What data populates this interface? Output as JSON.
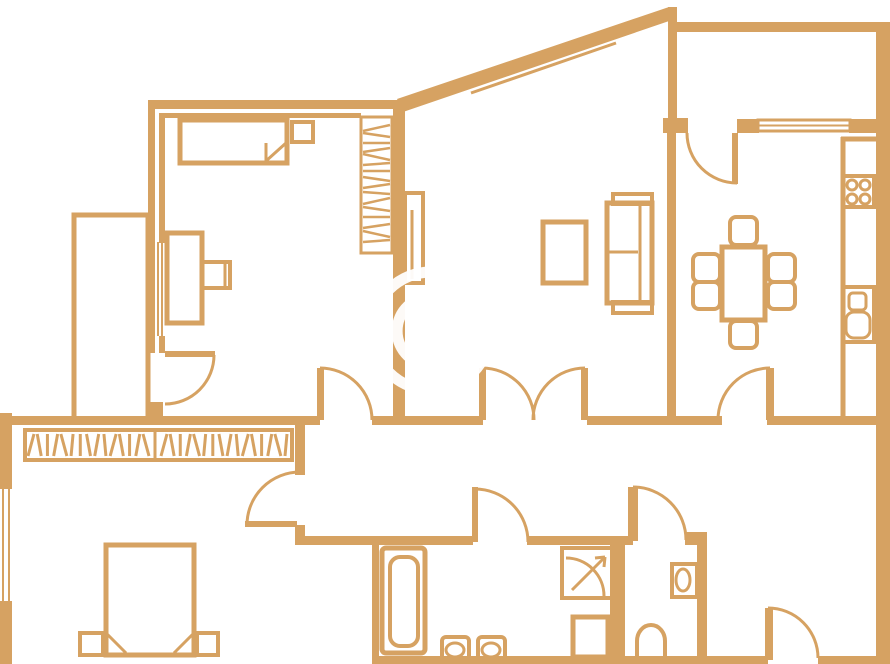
{
  "meta": {
    "description": "apartment floor plan line drawing",
    "watermark_symbol": "©"
  },
  "colors": {
    "background": "#ffffff",
    "wall": "#D6A262",
    "watermark": "#ffffff"
  },
  "canvas": {
    "width": 890,
    "height": 664
  },
  "hatch_pattern": [
    3,
    -2,
    0,
    2,
    -3,
    1,
    0,
    -2,
    2,
    -1
  ],
  "shapes": [
    {
      "name": "bedroom1-top-wall-outer",
      "type": "rect",
      "x": 148,
      "y": 100,
      "w": 258,
      "h": 9
    },
    {
      "name": "bedroom1-top-wall-inner",
      "type": "rect",
      "x": 160,
      "y": 113,
      "w": 201,
      "h": 5
    },
    {
      "name": "bedroom1-left-wall-outer",
      "type": "rect",
      "x": 148,
      "y": 100,
      "w": 7,
      "h": 253
    },
    {
      "name": "bedroom1-left-wall-inner",
      "type": "rect",
      "x": 159,
      "y": 113,
      "w": 6,
      "h": 130
    },
    {
      "name": "bedroom1-window-line-1",
      "type": "line",
      "x1": 154,
      "y1": 242,
      "x2": 154,
      "y2": 336,
      "sw": 2
    },
    {
      "name": "bedroom1-window-line-2",
      "type": "line",
      "x1": 158,
      "y1": 242,
      "x2": 158,
      "y2": 336,
      "sw": 2
    },
    {
      "name": "bedroom1-window-line-3",
      "type": "line",
      "x1": 162,
      "y1": 242,
      "x2": 162,
      "y2": 336,
      "sw": 2
    },
    {
      "name": "bedroom1-left-wall-inner-low",
      "type": "rect",
      "x": 159,
      "y": 336,
      "w": 6,
      "h": 17
    },
    {
      "name": "bedroom1-left-wall-foot",
      "type": "rect",
      "x": 148,
      "y": 402,
      "w": 15,
      "h": 23
    },
    {
      "name": "closet-room-outline",
      "type": "orect",
      "x": 74,
      "y": 215,
      "w": 74,
      "h": 207,
      "sw": 5
    },
    {
      "name": "corridor-wall-left",
      "type": "rect",
      "x": 0,
      "y": 416,
      "w": 320,
      "h": 9
    },
    {
      "name": "corridor-wall-mid",
      "type": "rect",
      "x": 372,
      "y": 416,
      "w": 111,
      "h": 9
    },
    {
      "name": "corridor-wall-right",
      "type": "rect",
      "x": 587,
      "y": 416,
      "w": 135,
      "h": 9
    },
    {
      "name": "corridor-wall-east",
      "type": "rect",
      "x": 767,
      "y": 416,
      "w": 115,
      "h": 9
    },
    {
      "name": "bedroom-living-divider-wall",
      "type": "rect",
      "x": 393,
      "y": 107,
      "w": 12,
      "h": 318
    },
    {
      "name": "diagonal-exterior-wall",
      "type": "poly",
      "points": "397,99 669,7 675,19 403,112"
    },
    {
      "name": "diagonal-window-line-1",
      "type": "line",
      "x1": 467,
      "y1": 85,
      "x2": 612,
      "y2": 35,
      "sw": 3
    },
    {
      "name": "diagonal-window-line-2",
      "type": "line",
      "x1": 471,
      "y1": 93,
      "x2": 616,
      "y2": 43,
      "sw": 3
    },
    {
      "name": "balcony-top-wall",
      "type": "rect",
      "x": 669,
      "y": 22,
      "w": 208,
      "h": 10
    },
    {
      "name": "balcony-left-wall",
      "type": "rect",
      "x": 668,
      "y": 7,
      "w": 9,
      "h": 126
    },
    {
      "name": "right-exterior-wall",
      "type": "rect",
      "x": 876,
      "y": 22,
      "w": 14,
      "h": 642
    },
    {
      "name": "kitchen-top-wall-stub",
      "type": "rect",
      "x": 663,
      "y": 118,
      "w": 25,
      "h": 15
    },
    {
      "name": "kitchen-top-wall-mid",
      "type": "rect",
      "x": 737,
      "y": 119,
      "w": 22,
      "h": 14
    },
    {
      "name": "kitchen-window-frame",
      "type": "orect",
      "x": 758,
      "y": 120,
      "w": 92,
      "h": 11,
      "sw": 3
    },
    {
      "name": "kitchen-window-midline",
      "type": "line",
      "x1": 758,
      "y1": 125.5,
      "x2": 850,
      "y2": 125.5,
      "sw": 2
    },
    {
      "name": "kitchen-top-wall-right",
      "type": "rect",
      "x": 849,
      "y": 119,
      "w": 28,
      "h": 14
    },
    {
      "name": "kitchen-living-divider-wall",
      "type": "rect",
      "x": 667,
      "y": 133,
      "w": 9,
      "h": 292
    },
    {
      "name": "bedroom2-left-exterior-wall",
      "type": "rect",
      "x": 0,
      "y": 413,
      "w": 12,
      "h": 251
    },
    {
      "name": "bedroom2-window-gap",
      "type": "rect",
      "x": 0,
      "y": 489,
      "w": 12,
      "h": 112,
      "fill": "#ffffff"
    },
    {
      "name": "bedroom2-window-line-1",
      "type": "line",
      "x1": 3,
      "y1": 489,
      "x2": 3,
      "y2": 601,
      "sw": 2
    },
    {
      "name": "bedroom2-window-line-2",
      "type": "line",
      "x1": 9,
      "y1": 489,
      "x2": 9,
      "y2": 601,
      "sw": 2
    },
    {
      "name": "bedroom2-right-wall-upper",
      "type": "rect",
      "x": 295,
      "y": 425,
      "w": 10,
      "h": 50
    },
    {
      "name": "bedroom2-right-wall-corner",
      "type": "rect",
      "x": 295,
      "y": 525,
      "w": 10,
      "h": 18
    },
    {
      "name": "hall-bottom-wall-1",
      "type": "rect",
      "x": 295,
      "y": 536,
      "w": 178,
      "h": 9
    },
    {
      "name": "hall-bottom-wall-2",
      "type": "rect",
      "x": 527,
      "y": 536,
      "w": 106,
      "h": 9
    },
    {
      "name": "hall-bottom-wall-3",
      "type": "rect",
      "x": 685,
      "y": 532,
      "w": 22,
      "h": 13
    },
    {
      "name": "bathroom-left-wall",
      "type": "rect",
      "x": 372,
      "y": 543,
      "w": 7,
      "h": 121
    },
    {
      "name": "bathroom-wc-wall",
      "type": "rect",
      "x": 610,
      "y": 543,
      "w": 15,
      "h": 121
    },
    {
      "name": "wc-right-wall",
      "type": "rect",
      "x": 697,
      "y": 543,
      "w": 10,
      "h": 121
    },
    {
      "name": "bottom-exterior-wall-1",
      "type": "rect",
      "x": 372,
      "y": 656,
      "w": 396,
      "h": 8
    },
    {
      "name": "bottom-exterior-wall-2",
      "type": "rect",
      "x": 818,
      "y": 656,
      "w": 72,
      "h": 8
    },
    {
      "name": "closet-door-leaf",
      "type": "rect",
      "x": 165,
      "y": 351,
      "w": 50,
      "h": 6
    },
    {
      "name": "closet-door-swing",
      "type": "path",
      "d": "M214,355 A49 49 0 0 1 165,404",
      "sw": 3
    },
    {
      "name": "bedroom1-door-leaf",
      "type": "rect",
      "x": 317,
      "y": 368,
      "w": 7,
      "h": 52
    },
    {
      "name": "bedroom1-door-swing",
      "type": "path",
      "d": "M320,368 A52 52 0 0 1 372,420",
      "sw": 3
    },
    {
      "name": "living-double-door-leaf-left",
      "type": "rect",
      "x": 479,
      "y": 368,
      "w": 7,
      "h": 52
    },
    {
      "name": "living-double-door-swing-left",
      "type": "path",
      "d": "M482,368 A52 52 0 0 1 534,420",
      "sw": 3
    },
    {
      "name": "living-double-door-leaf-right",
      "type": "rect",
      "x": 581,
      "y": 368,
      "w": 7,
      "h": 52
    },
    {
      "name": "living-double-door-swing-right",
      "type": "path",
      "d": "M585,368 A52 52 0 0 0 533,420",
      "sw": 3
    },
    {
      "name": "kitchen-door-leaf",
      "type": "rect",
      "x": 766,
      "y": 368,
      "w": 8,
      "h": 52
    },
    {
      "name": "kitchen-door-swing",
      "type": "path",
      "d": "M770,368 A52 52 0 0 0 718,420",
      "sw": 3
    },
    {
      "name": "balcony-door-leaf",
      "type": "rect",
      "x": 732,
      "y": 133,
      "w": 6,
      "h": 51
    },
    {
      "name": "balcony-door-swing",
      "type": "path",
      "d": "M687,133 A50 50 0 0 0 737,183",
      "sw": 3
    },
    {
      "name": "bedroom2-door-leaf",
      "type": "rect",
      "x": 245,
      "y": 521,
      "w": 52,
      "h": 6
    },
    {
      "name": "bedroom2-door-swing",
      "type": "path",
      "d": "M247,525 A53 53 0 0 1 300,472",
      "sw": 3
    },
    {
      "name": "bathroom-door-leaf",
      "type": "rect",
      "x": 472,
      "y": 487,
      "w": 6,
      "h": 55
    },
    {
      "name": "bathroom-door-swing",
      "type": "path",
      "d": "M475,489 A53 53 0 0 1 528,542",
      "sw": 3
    },
    {
      "name": "wc-door-leaf",
      "type": "rect",
      "x": 628,
      "y": 487,
      "w": 10,
      "h": 54
    },
    {
      "name": "wc-door-swing",
      "type": "path",
      "d": "M633,487 A53 53 0 0 1 686,540",
      "sw": 3
    },
    {
      "name": "entrance-door-leaf",
      "type": "rect",
      "x": 765,
      "y": 608,
      "w": 8,
      "h": 52
    },
    {
      "name": "entrance-door-swing",
      "type": "path",
      "d": "M768,608 A50 50 0 0 1 818,658",
      "sw": 3
    },
    {
      "name": "bedroom1-bed",
      "type": "orect",
      "x": 180,
      "y": 120,
      "w": 107,
      "h": 43,
      "sw": 5
    },
    {
      "name": "bedroom1-bed-fold-line",
      "type": "line",
      "x1": 266,
      "y1": 143,
      "x2": 266,
      "y2": 161,
      "sw": 3
    },
    {
      "name": "bedroom1-bed-fold-diag",
      "type": "line",
      "x1": 266,
      "y1": 161,
      "x2": 286,
      "y2": 143,
      "sw": 3
    },
    {
      "name": "bedroom1-nightstand",
      "type": "orect",
      "x": 292,
      "y": 122,
      "w": 21,
      "h": 20,
      "sw": 4
    },
    {
      "name": "bedroom1-desk",
      "type": "orect",
      "x": 167,
      "y": 233,
      "w": 35,
      "h": 90,
      "sw": 5
    },
    {
      "name": "bedroom1-chair",
      "type": "orect",
      "x": 202,
      "y": 262,
      "w": 28,
      "h": 26,
      "sw": 4
    },
    {
      "name": "bedroom1-chair-back",
      "type": "line",
      "x1": 225,
      "y1": 264,
      "x2": 225,
      "y2": 286,
      "sw": 3
    },
    {
      "name": "wardrobe-outline",
      "type": "orect",
      "x": 361,
      "y": 117,
      "w": 31,
      "h": 136,
      "sw": 3
    },
    {
      "name": "wardrobe-hangers-hatch",
      "type": "hhatch",
      "x0": 363,
      "x1": 390,
      "ys": [
        128,
        135,
        143,
        150,
        157,
        164,
        171,
        179,
        186,
        193,
        201,
        209,
        217,
        226,
        234,
        241
      ]
    },
    {
      "name": "sliding-panel",
      "type": "orect",
      "x": 405,
      "y": 193,
      "w": 18,
      "h": 90,
      "sw": 4
    },
    {
      "name": "sliding-panel-inner-line",
      "type": "line",
      "x1": 412,
      "y1": 210,
      "x2": 412,
      "y2": 279,
      "sw": 3
    },
    {
      "name": "tv-stand",
      "type": "orect",
      "x": 543,
      "y": 222,
      "w": 43,
      "h": 61,
      "sw": 5
    },
    {
      "name": "sofa-body",
      "type": "orect",
      "x": 607,
      "y": 203,
      "w": 45,
      "h": 100,
      "sw": 5
    },
    {
      "name": "sofa-back-line",
      "type": "line",
      "x1": 640,
      "y1": 205,
      "x2": 640,
      "y2": 301,
      "sw": 3
    },
    {
      "name": "sofa-seat-line",
      "type": "line",
      "x1": 609,
      "y1": 252,
      "x2": 638,
      "y2": 252,
      "sw": 3
    },
    {
      "name": "sofa-armrest-top",
      "type": "orect",
      "x": 613,
      "y": 194,
      "w": 39,
      "h": 10,
      "sw": 4
    },
    {
      "name": "sofa-armrest-bottom",
      "type": "orect",
      "x": 613,
      "y": 302,
      "w": 39,
      "h": 11,
      "sw": 4
    },
    {
      "name": "dining-table",
      "type": "orect",
      "x": 722,
      "y": 247,
      "w": 43,
      "h": 73,
      "sw": 5
    },
    {
      "name": "dining-chair-top",
      "type": "orect",
      "x": 730,
      "y": 217,
      "w": 27,
      "h": 28,
      "sw": 4,
      "rx": 6
    },
    {
      "name": "dining-chair-left-1",
      "type": "orect",
      "x": 693,
      "y": 254,
      "w": 27,
      "h": 28,
      "sw": 4,
      "rx": 6
    },
    {
      "name": "dining-chair-left-2",
      "type": "orect",
      "x": 693,
      "y": 282,
      "w": 27,
      "h": 27,
      "sw": 4,
      "rx": 6
    },
    {
      "name": "dining-chair-right-1",
      "type": "orect",
      "x": 768,
      "y": 254,
      "w": 27,
      "h": 28,
      "sw": 4,
      "rx": 6
    },
    {
      "name": "dining-chair-right-2",
      "type": "orect",
      "x": 768,
      "y": 282,
      "w": 27,
      "h": 27,
      "sw": 4,
      "rx": 6
    },
    {
      "name": "dining-chair-bottom",
      "type": "orect",
      "x": 730,
      "y": 321,
      "w": 27,
      "h": 27,
      "sw": 4,
      "rx": 6
    },
    {
      "name": "kitchen-counter-left-edge",
      "type": "line",
      "x1": 843,
      "y1": 137,
      "x2": 843,
      "y2": 416,
      "sw": 5
    },
    {
      "name": "kitchen-counter-top-edge",
      "type": "line",
      "x1": 841,
      "y1": 139,
      "x2": 876,
      "y2": 139,
      "sw": 5
    },
    {
      "name": "stove-box",
      "type": "orect",
      "x": 843,
      "y": 176,
      "w": 31,
      "h": 31,
      "sw": 4
    },
    {
      "name": "stove-burner-1",
      "type": "circle",
      "cx": 852,
      "cy": 185,
      "r": 5,
      "sw": 3
    },
    {
      "name": "stove-burner-2",
      "type": "circle",
      "cx": 865,
      "cy": 185,
      "r": 5,
      "sw": 3
    },
    {
      "name": "stove-burner-3",
      "type": "circle",
      "cx": 852,
      "cy": 199,
      "r": 5,
      "sw": 3
    },
    {
      "name": "stove-burner-4",
      "type": "circle",
      "cx": 865,
      "cy": 199,
      "r": 5,
      "sw": 3
    },
    {
      "name": "kitchen-sink-box",
      "type": "orect",
      "x": 843,
      "y": 287,
      "w": 31,
      "h": 55,
      "sw": 4
    },
    {
      "name": "kitchen-sink-basin-small",
      "type": "orect",
      "x": 849,
      "y": 293,
      "w": 17,
      "h": 17,
      "sw": 3,
      "rx": 4
    },
    {
      "name": "kitchen-sink-basin-large",
      "type": "orect",
      "x": 846,
      "y": 312,
      "w": 24,
      "h": 26,
      "sw": 3,
      "rx": 8
    },
    {
      "name": "bookshelf-outline",
      "type": "orect",
      "x": 25,
      "y": 430,
      "w": 267,
      "h": 30,
      "sw": 4
    },
    {
      "name": "bookshelf-divider",
      "type": "line",
      "x1": 155,
      "y1": 432,
      "x2": 155,
      "y2": 458,
      "sw": 3
    },
    {
      "name": "bookshelf-books-left",
      "type": "books",
      "x0": 31,
      "x1": 146,
      "n": 15,
      "y0": 434,
      "y1": 456
    },
    {
      "name": "bookshelf-books-right",
      "type": "books",
      "x0": 164,
      "x1": 286,
      "n": 16,
      "y0": 434,
      "y1": 456
    },
    {
      "name": "bedroom2-bed",
      "type": "orect",
      "x": 106,
      "y": 545,
      "w": 88,
      "h": 110,
      "sw": 5
    },
    {
      "name": "bedroom2-bed-fold-left",
      "type": "line",
      "x1": 107,
      "y1": 634,
      "x2": 126,
      "y2": 653,
      "sw": 3
    },
    {
      "name": "bedroom2-bed-fold-right",
      "type": "line",
      "x1": 193,
      "y1": 634,
      "x2": 174,
      "y2": 653,
      "sw": 3
    },
    {
      "name": "bedroom2-nightstand-left",
      "type": "orect",
      "x": 80,
      "y": 633,
      "w": 23,
      "h": 22,
      "sw": 4
    },
    {
      "name": "bedroom2-nightstand-right",
      "type": "orect",
      "x": 197,
      "y": 633,
      "w": 21,
      "h": 22,
      "sw": 4
    },
    {
      "name": "bathtub-outer",
      "type": "orect",
      "x": 382,
      "y": 548,
      "w": 43,
      "h": 105,
      "sw": 5,
      "rx": 4
    },
    {
      "name": "bathtub-inner",
      "type": "orect",
      "x": 390,
      "y": 557,
      "w": 28,
      "h": 89,
      "sw": 4,
      "rx": 10
    },
    {
      "name": "washbasin-1-box",
      "type": "orect",
      "x": 442,
      "y": 637,
      "w": 27,
      "h": 25,
      "sw": 4,
      "rx": 4
    },
    {
      "name": "washbasin-1-bowl",
      "type": "ellipse",
      "cx": 455,
      "cy": 650,
      "rx": 9,
      "ry": 7,
      "sw": 3
    },
    {
      "name": "washbasin-2-box",
      "type": "orect",
      "x": 478,
      "y": 637,
      "w": 27,
      "h": 25,
      "sw": 4,
      "rx": 4
    },
    {
      "name": "washbasin-2-bowl",
      "type": "ellipse",
      "cx": 491,
      "cy": 650,
      "rx": 9,
      "ry": 7,
      "sw": 3
    },
    {
      "name": "shower-box",
      "type": "orect",
      "x": 562,
      "y": 548,
      "w": 50,
      "h": 50,
      "sw": 4
    },
    {
      "name": "shower-arc",
      "type": "path",
      "d": "M566,558 A38 38 0 0 1 604,596",
      "sw": 3
    },
    {
      "name": "shower-arrow-diag",
      "type": "line",
      "x1": 572,
      "y1": 590,
      "x2": 605,
      "y2": 557,
      "sw": 3
    },
    {
      "name": "shower-arrow-head-1",
      "type": "line",
      "x1": 605,
      "y1": 557,
      "x2": 595,
      "y2": 558,
      "sw": 3
    },
    {
      "name": "shower-arrow-head-2",
      "type": "line",
      "x1": 605,
      "y1": 557,
      "x2": 604,
      "y2": 567,
      "sw": 3
    },
    {
      "name": "washing-machine",
      "type": "orect",
      "x": 573,
      "y": 617,
      "w": 35,
      "h": 40,
      "sw": 5
    },
    {
      "name": "toilet-box",
      "type": "orect",
      "x": 672,
      "y": 564,
      "w": 25,
      "h": 33,
      "sw": 4
    },
    {
      "name": "toilet-bowl",
      "type": "ellipse",
      "cx": 683,
      "cy": 580,
      "rx": 7,
      "ry": 11,
      "sw": 3
    },
    {
      "name": "bidet",
      "type": "path",
      "d": "M637,661 L637,641 A14 16 0 0 1 665,641 L665,661",
      "sw": 4
    },
    {
      "name": "watermark-circle",
      "type": "circle",
      "cx": 431,
      "cy": 331,
      "r": 59,
      "sw": 11,
      "stroke": "#ffffff",
      "opacity": 0.95
    },
    {
      "name": "watermark-letter-c",
      "type": "path",
      "d": "M457.1,352.9 A34 34 0 1 1 457.1,309.1",
      "sw": 11,
      "stroke": "#ffffff",
      "opacity": 0.95
    }
  ]
}
